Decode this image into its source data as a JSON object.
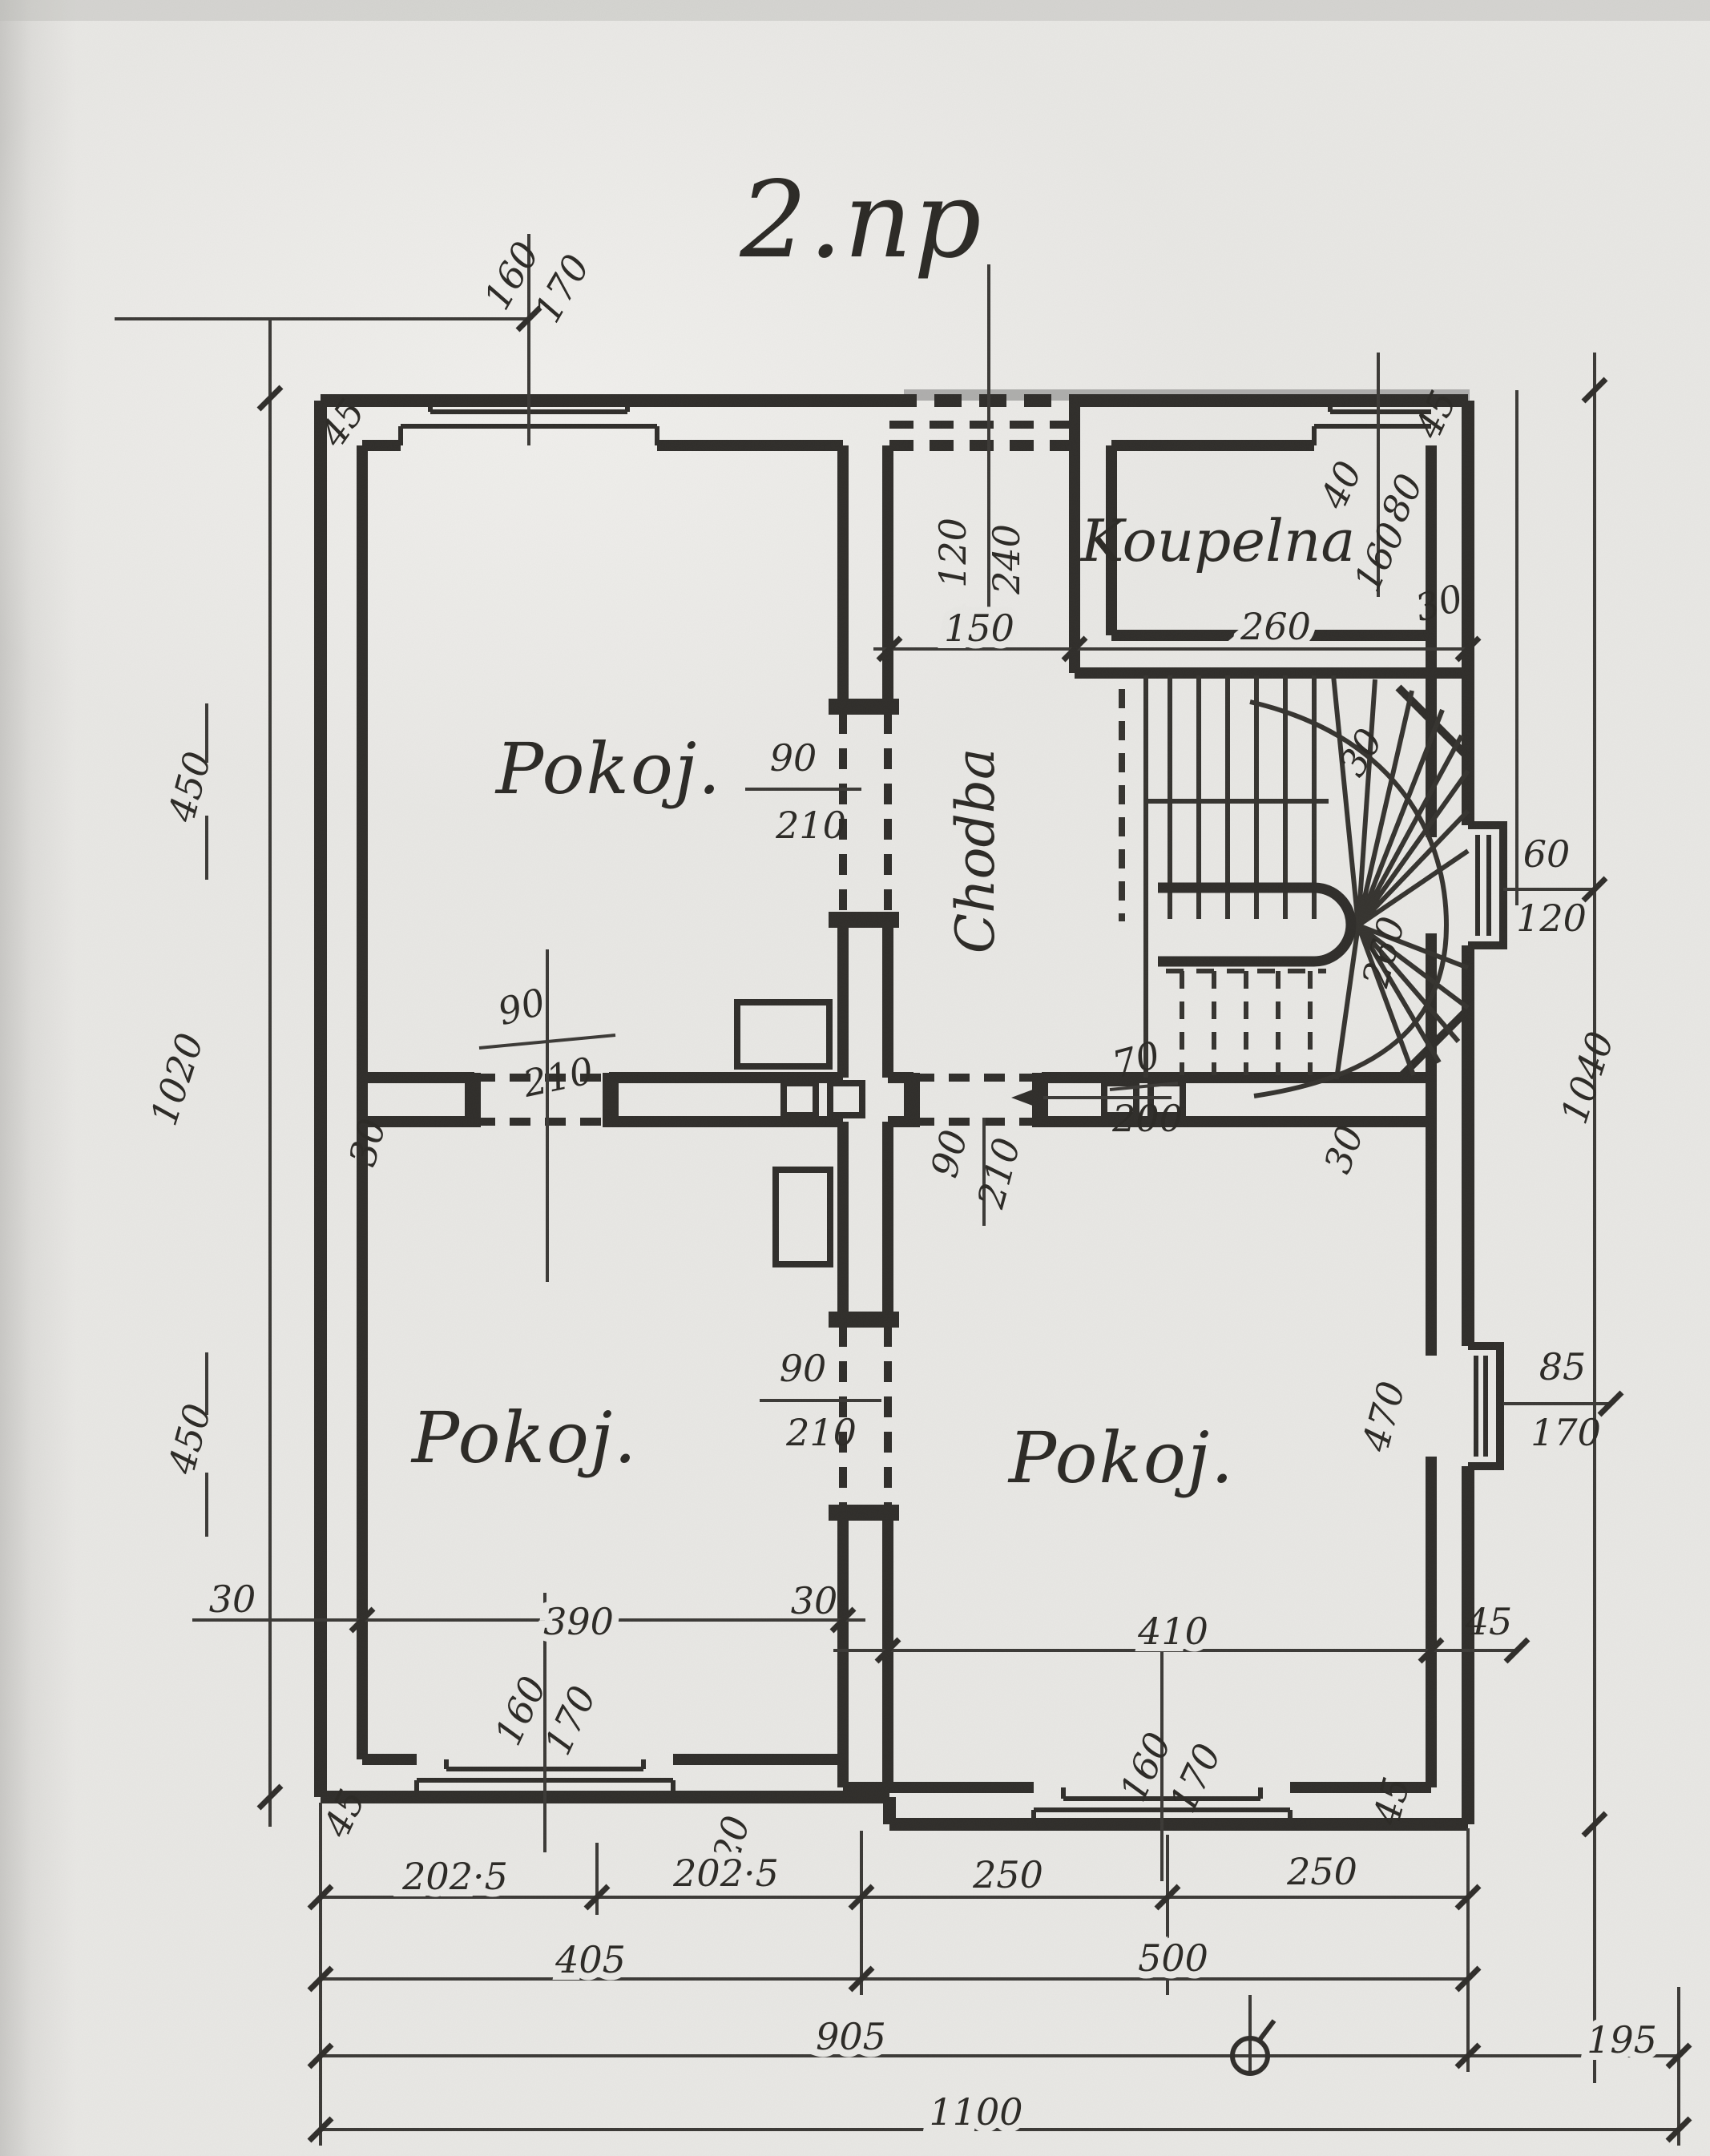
{
  "title": "2.np",
  "rooms": {
    "pokoj1": "Pokoj.",
    "pokoj2": "Pokoj.",
    "pokoj3": "Pokoj.",
    "koupelna": "Koupelna",
    "chodba": "Chodba"
  },
  "windows": {
    "top_left": [
      "160",
      "170"
    ],
    "bath": [
      "160",
      "80"
    ],
    "right_upper": [
      "60",
      "120"
    ],
    "right_lower": [
      "85",
      "170"
    ],
    "bottom_left": [
      "160",
      "170"
    ],
    "bottom_right": [
      "160",
      "170"
    ]
  },
  "doors": {
    "hall": [
      "90",
      "210"
    ],
    "mid": [
      "90",
      "210"
    ],
    "p3": [
      "90",
      "210"
    ],
    "p23": [
      "90",
      "210"
    ],
    "stair": [
      "70",
      "200"
    ]
  },
  "walls": {
    "tl_corner": "45",
    "tr_corner": "45",
    "bath_wall": "30",
    "bath_pier": "40",
    "stair_wall": "30",
    "mid_left": "30",
    "mid_right": "30",
    "bottom_left": "30",
    "bottom_center": "30",
    "br_corner_a": "45",
    "br_corner_b": "45",
    "bl_corner": "45",
    "step": "20"
  },
  "room_dims": {
    "room1_h": "450",
    "room2_h": "450",
    "room3_h": "470",
    "room2_w": "390",
    "room3_w": "410",
    "hall_w": "150",
    "bath_w": "260",
    "stair_w": "260",
    "left_height": "1020",
    "right_height": "1040"
  },
  "chains": {
    "row1": [
      "202·5",
      "202·5",
      "250",
      "250"
    ],
    "row2": [
      "405",
      "500"
    ],
    "row3": [
      "905",
      "195"
    ],
    "row4": [
      "1100"
    ]
  }
}
